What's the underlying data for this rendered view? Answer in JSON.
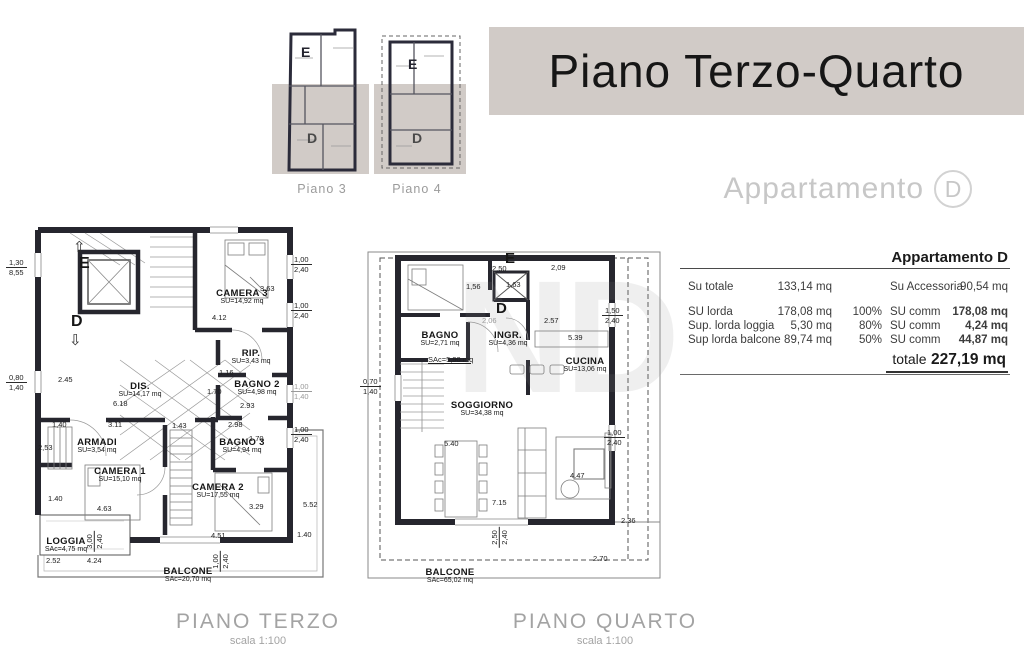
{
  "banner": {
    "title": "Piano Terzo-Quarto"
  },
  "apartment_heading": {
    "label": "Appartamento",
    "letter": "D"
  },
  "watermark": "ND",
  "key_plans": {
    "left_caption": "Piano 3",
    "right_caption": "Piano 4",
    "left_e": "E",
    "left_d": "D",
    "right_e": "E",
    "right_d": "D"
  },
  "table": {
    "title": "Appartamento D",
    "rows": [
      {
        "c1": "Su totale",
        "c2": "133,14 mq",
        "c3": "",
        "c4": "Su Accessoria",
        "c5": "90,54 mq"
      },
      {
        "c1": "SU lorda",
        "c2": "178,08 mq",
        "c3": "100%",
        "c4": "SU comm",
        "c5": "178,08 mq"
      },
      {
        "c1": "Sup. lorda loggia",
        "c2": "5,30 mq",
        "c3": "80%",
        "c4": "SU comm",
        "c5": "4,24 mq"
      },
      {
        "c1": "Sup lorda balcone",
        "c2": "89,74 mq",
        "c3": "50%",
        "c4": "SU comm",
        "c5": "44,87 mq"
      }
    ],
    "total_label": "totale",
    "total_value": "227,19 mq"
  },
  "plan_terzo": {
    "caption": "PIANO TERZO",
    "scale": "scala 1:100",
    "marker_e": "E",
    "marker_d": "D",
    "arrow_up": "⇧",
    "arrow_down": "⇩",
    "rooms": {
      "camera3": {
        "name": "CAMERA 3",
        "area": "SU=14,92 mq"
      },
      "rip": {
        "name": "RIP.",
        "area": "SU=3,43 mq"
      },
      "bagno2": {
        "name": "BAGNO 2",
        "area": "SU=4,98 mq"
      },
      "dis": {
        "name": "DIS.",
        "area": "SU=14,17 mq"
      },
      "armadi": {
        "name": "ARMADI",
        "area": "SU=3,54 mq"
      },
      "camera1": {
        "name": "CAMERA 1",
        "area": "SU=15,10 mq"
      },
      "bagno3": {
        "name": "BAGNO 3",
        "area": "SU=4,94 mq"
      },
      "camera2": {
        "name": "CAMERA 2",
        "area": "SU=17,55 mq"
      },
      "loggia": {
        "name": "LOGGIA",
        "area": "SAc=4,75 mq"
      },
      "balcone": {
        "name": "BALCONE",
        "area": "SAc=20,70 mq"
      }
    },
    "dims": {
      "l1a": "1,30",
      "l1b": "8,55",
      "l2a": "0,80",
      "l2b": "1,40",
      "h245": "2.45",
      "c3h": "3.63",
      "c3w": "4.12",
      "rip_w": "1.16",
      "b2h": "1.70",
      "b2w": "2.93",
      "disw": "6.18",
      "d311": "3.11",
      "d143": "1.43",
      "d140": "1,40",
      "armh": "2,53",
      "c1h": "1.40",
      "c1w": "4.63",
      "b3h": "1.70",
      "b3w": "2.98",
      "c2h": "3.29",
      "c2w": "4.51",
      "r552": "5.52",
      "r140": "1.40",
      "loga": "3,00",
      "logb": "2,40",
      "l252": "2.52",
      "l424": "4.24",
      "bala": "1,00",
      "balb": "2,40",
      "w1a": "1,00",
      "w1b": "2,40",
      "w2a": "1,00",
      "w2b": "2,40",
      "w3a": "1,00",
      "w3b": "1,40",
      "w4a": "1,00",
      "w4b": "2,40"
    }
  },
  "plan_quarto": {
    "caption": "PIANO QUARTO",
    "scale": "scala 1:100",
    "marker_e": "E",
    "marker_d": "D",
    "stair_area": "SAc=5,90 mq",
    "rooms": {
      "bagno": {
        "name": "BAGNO",
        "area": "SU=2,71 mq"
      },
      "ingr": {
        "name": "INGR.",
        "area": "SU=4,36 mq"
      },
      "cucina": {
        "name": "CUCINA",
        "area": "SU=13,06 mq"
      },
      "soggiorno": {
        "name": "SOGGIORNO",
        "area": "SU=34,38 mq"
      },
      "balcone": {
        "name": "BALCONE",
        "area": "SAc=65,02 mq"
      }
    },
    "dims": {
      "t250": "2,50",
      "elev": "1,63",
      "v156": "1,56",
      "t209": "2,09",
      "g206": "2,06",
      "h257": "2.57",
      "v539": "5.39",
      "wra": "1,50",
      "wrb": "2,40",
      "wla": "0,70",
      "wlb": "1,40",
      "s540": "5.40",
      "s447": "4.47",
      "s715": "7.15",
      "wr2a": "1,00",
      "wr2b": "2,40",
      "bwa": "2,50",
      "bwb": "2,40",
      "r236": "2.36",
      "b270": "2.70"
    }
  }
}
